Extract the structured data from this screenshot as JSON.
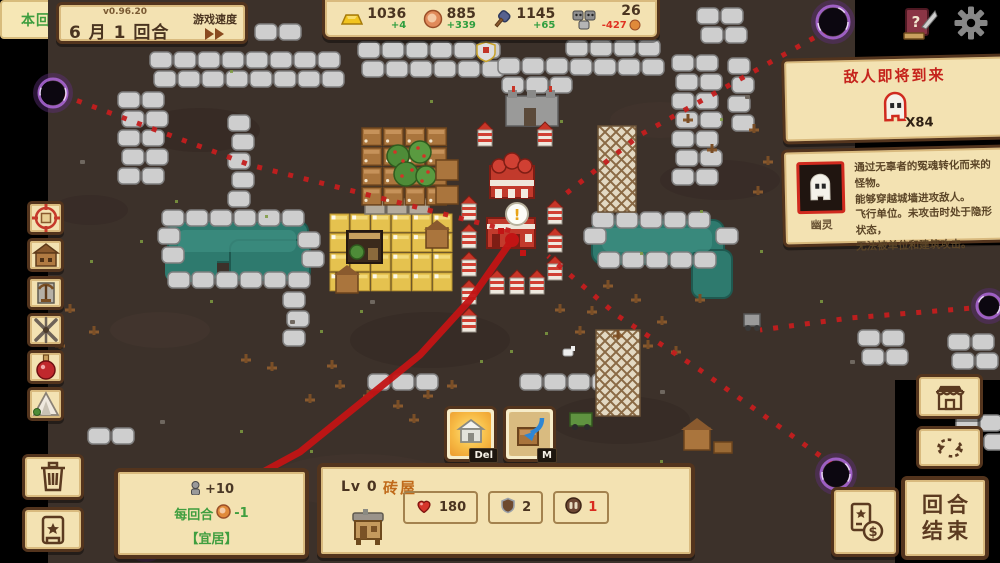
{
  "header": {
    "version": "v0.96.20",
    "turn_date": "6 月 1 回合",
    "speed_label": "游戏速度",
    "resources": [
      {
        "icon": "gold-icon",
        "value": "1036",
        "delta": "+4"
      },
      {
        "icon": "meat-icon",
        "value": "885",
        "delta": "+339"
      },
      {
        "icon": "tool-icon",
        "value": "1145",
        "delta": "+65"
      },
      {
        "icon": "population-icon",
        "value": "26",
        "delta": "-427"
      }
    ]
  },
  "enemy_panel": {
    "title": "敌人即将到来",
    "count_label": "X84"
  },
  "unit_panel": {
    "unit_name": "幽灵",
    "lines": [
      "通过无辜者的冤魂转化而来的怪物。",
      "能够穿越城墙进攻敌人。",
      "飞行单位。未攻击时处于隐形状态，",
      "无法被单位和建筑攻击。"
    ]
  },
  "caravan_tooltip": {
    "text": "本回合有商队到"
  },
  "building_panel": {
    "level": "Lv 0",
    "name": "砖屋",
    "hp": "180",
    "armor": "2",
    "occupancy": "1"
  },
  "effect_panel": {
    "population_bonus": "+10",
    "upkeep_prefix": "每回合",
    "upkeep_value": "-1",
    "trait": "【宜居】"
  },
  "hotbar": {
    "slot1_key": "Del",
    "slot2_key": "M"
  },
  "buttons": {
    "end_turn_line1": "回合",
    "end_turn_line2": "结束"
  },
  "map": {
    "alert_marker": "!"
  },
  "icons": {
    "question": "?",
    "dollar": "$"
  }
}
